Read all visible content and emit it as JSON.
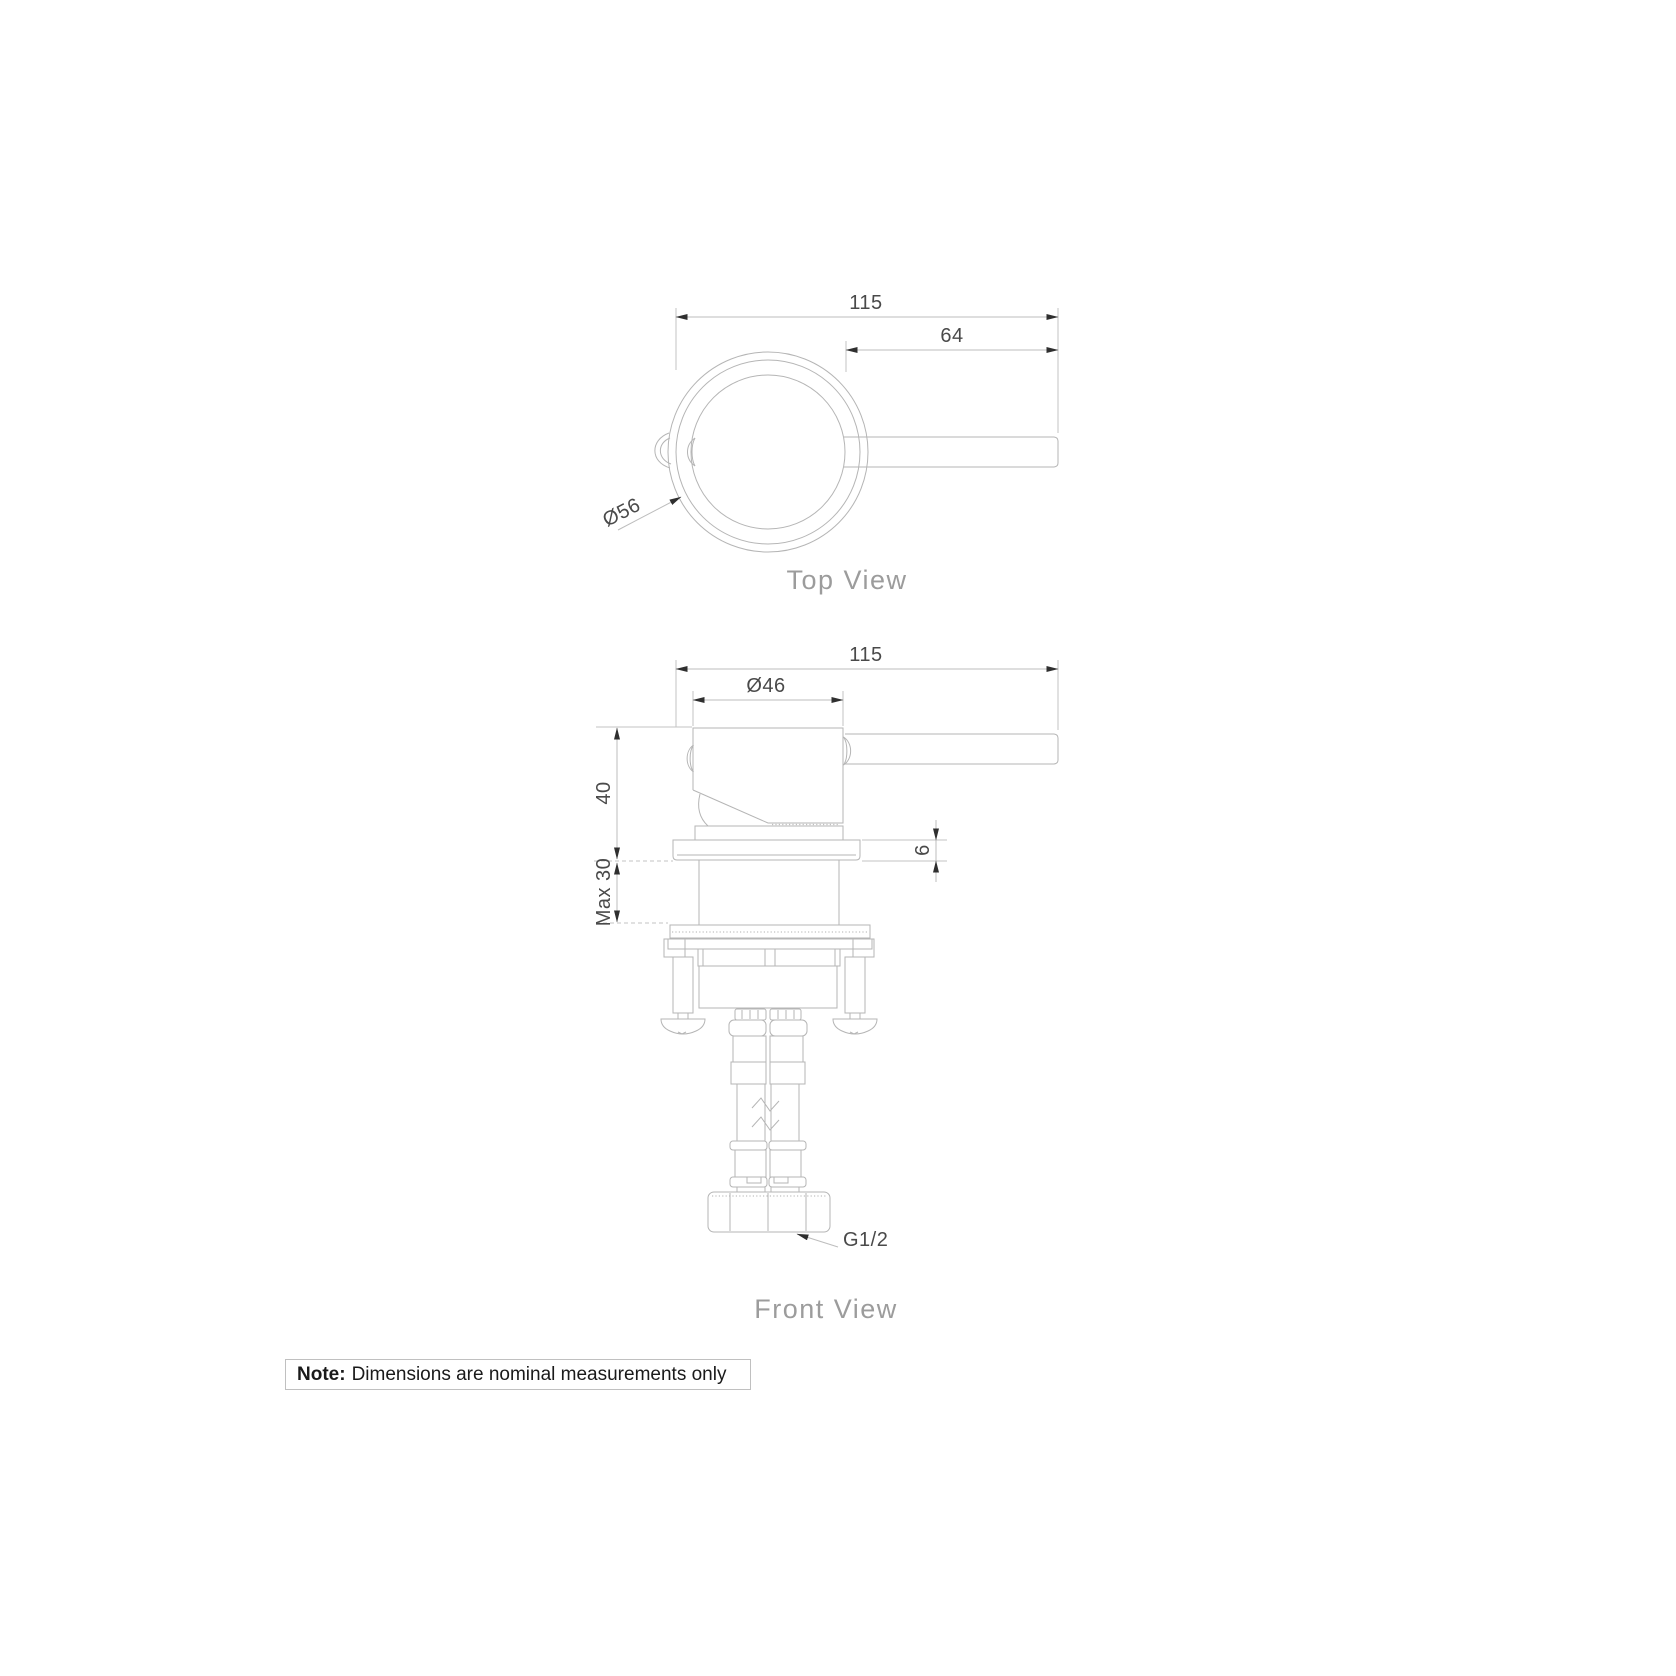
{
  "views": {
    "top": {
      "label": "Top View",
      "dims": {
        "overall": "115",
        "handle": "64",
        "diameter": "Ø56"
      }
    },
    "front": {
      "label": "Front View",
      "dims": {
        "overall": "115",
        "body_diameter": "Ø46",
        "height": "40",
        "plate_thickness": "6",
        "max_mounting": "Max 30",
        "thread": "G1/2"
      }
    }
  },
  "note": {
    "label": "Note:",
    "text": "Dimensions are nominal measurements only"
  },
  "colors": {
    "background": "#ffffff",
    "drawing_line": "#b5b5b5",
    "dimension_line": "#bdbdbd",
    "dimension_text": "#4a4a4a",
    "view_label_text": "#9c9c9c",
    "arrowhead": "#2f2f2f",
    "note_text": "#1a1a1a",
    "note_border": "#c0c0c0"
  }
}
